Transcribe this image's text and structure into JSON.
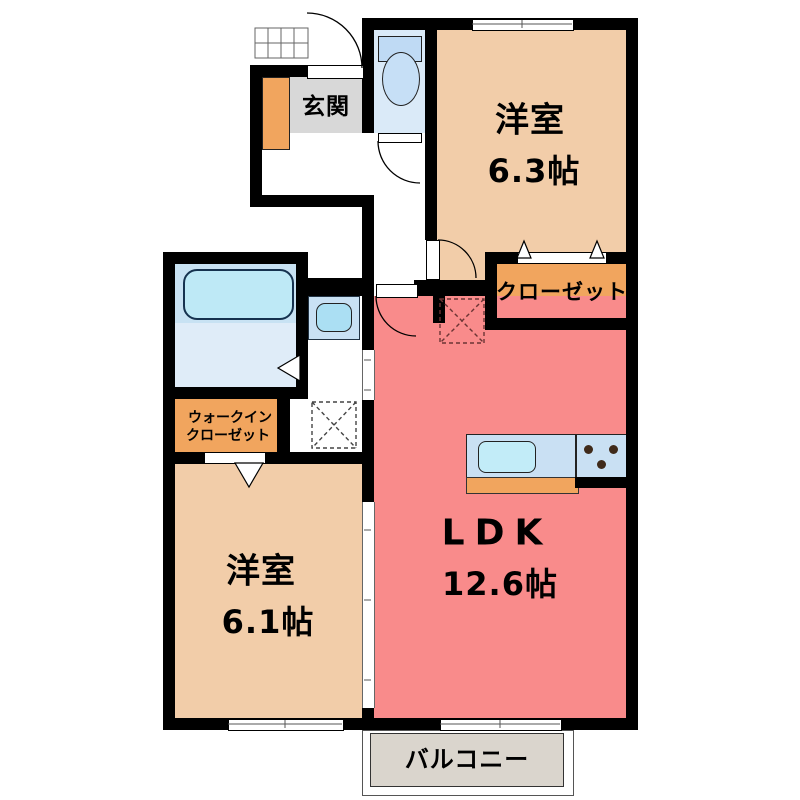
{
  "plan": {
    "entrance": {
      "label": "玄関"
    },
    "bedroom_top": {
      "name": "洋室",
      "size": "6.3帖"
    },
    "closet": {
      "label": "クローゼット"
    },
    "walk_in_closet": {
      "line1": "ウォークイン",
      "line2": "クローゼット"
    },
    "bedroom_bottom": {
      "name": "洋室",
      "size": "6.1帖"
    },
    "ldk": {
      "name": "LDK",
      "size": "12.6帖"
    },
    "balcony": {
      "label": "バルコニー"
    },
    "fixtures": [
      "bathtub",
      "toilet",
      "wash-basin",
      "kitchen-sink",
      "stove-burners",
      "washing-machine-space",
      "refrigerator-space",
      "shoe-cabinet",
      "entrance-porch"
    ],
    "colors": {
      "wall": "#000000",
      "bedroom_floor": "#F2CDA9",
      "closet_floor": "#F1A55E",
      "ldk_floor": "#F98B8B",
      "bathroom_floor": "#C8E2F3",
      "toilet_floor": "#DAEAF8",
      "genkan_floor": "#D8D8D8",
      "balcony_floor": "#DAD5CD",
      "fixture_blue": "#BEE9F6"
    }
  }
}
